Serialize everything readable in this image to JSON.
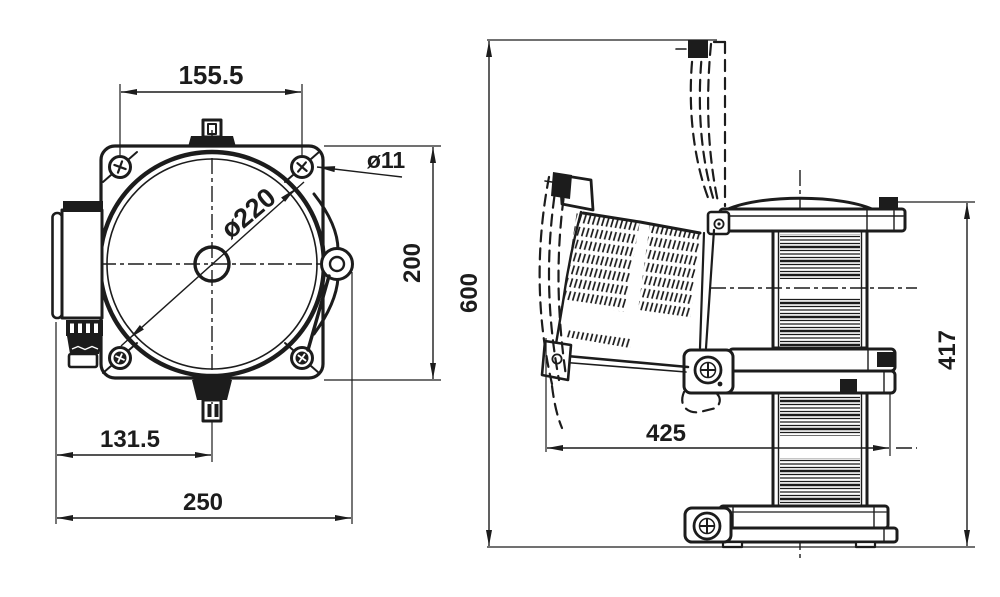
{
  "front_view": {
    "dimensions": {
      "mounting_holes_width": "155.5",
      "mounting_hole_diameter": "ø11",
      "body_diameter": "ø220",
      "plate_height": "200",
      "center_offset": "131.5",
      "overall_width": "250"
    }
  },
  "side_view": {
    "dimensions": {
      "overall_height_open": "600",
      "swing_clearance_width": "425",
      "lantern_height": "417"
    }
  },
  "colors": {
    "ink": "#1c1c1c",
    "background": "#ffffff"
  }
}
